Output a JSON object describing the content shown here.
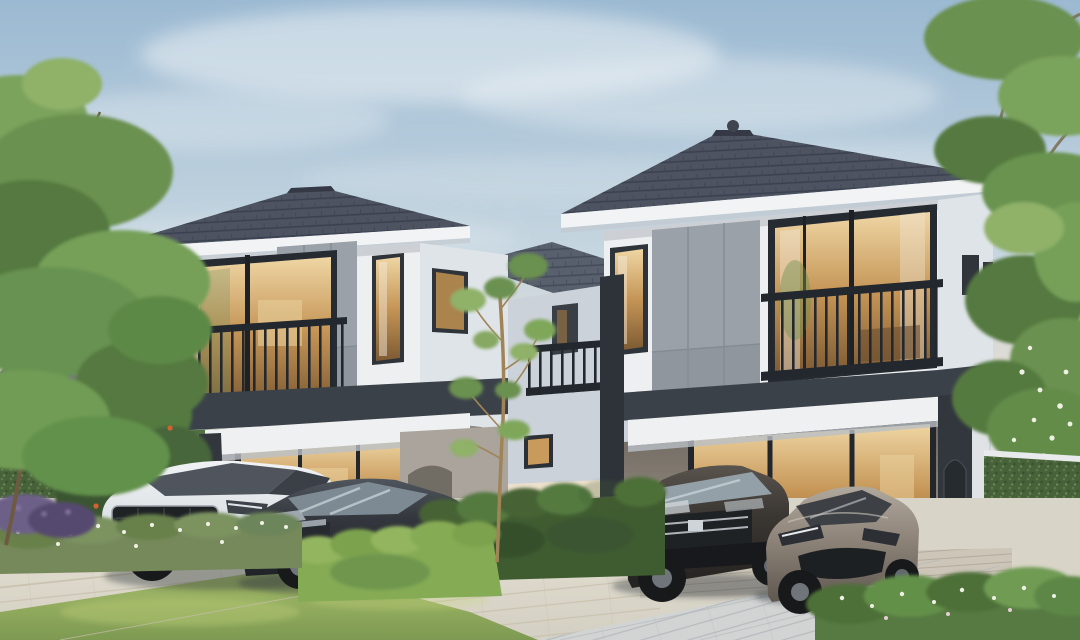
{
  "scene": {
    "description": "Dusk 3D exterior rendering of two modern two-storey houses with dark hip tile roofs, balconies with railings, and ground-floor carports; four cars parked; landscaped garden, hedges and paved driveway",
    "left_house": {
      "label": "left house",
      "cars": [
        "white SUV",
        "dark grey hatchback"
      ]
    },
    "right_house": {
      "label": "right house",
      "cars": [
        "dark grey SUV",
        "bronze-grey coupe"
      ]
    },
    "background": [
      "neighbouring house far left",
      "ivy-covered boundary walls",
      "large tree overhanging on the left",
      "tree branches overhanging top right",
      "young sapling between the houses"
    ],
    "foreground": [
      "pale paved driveway",
      "lawn",
      "trimmed hedges",
      "white flowering shrubs",
      "red flowering bush",
      "purple flowering bushes",
      "stepping stones",
      "deck strip"
    ]
  },
  "colors": {
    "sky_top": "#9bb9d2",
    "sky_mid": "#c6d6e0",
    "sky_low": "#e6ddd0",
    "sky_warm": "#f2e2c9",
    "cloud": "#f4f7f8",
    "roof": "#4d5360",
    "ridge": "#343945",
    "fascia": "#f1f3f4",
    "wall": "#edeff1",
    "wall_side": "#dfe4e9",
    "wall_shade": "#ccd2da",
    "bg_wall": "#e9e6df",
    "panel": "#9aa1a9",
    "band": "#3b4149",
    "beam": "#eef0f1",
    "frame": "#262b31",
    "rail": "#23282e",
    "glass_warm_hi": "#efd6a4",
    "glass_warm_mid": "#c49455",
    "glass_warm_lo": "#7d5a33",
    "ivy": "#47623a",
    "hedge_dark": "#3f5c31",
    "hedge_mid": "#557a41",
    "hedge_bright": "#86ab55",
    "grass_hi": "#a9bf6c",
    "grass_lo": "#7e9a52",
    "tree_green": "#6b9150",
    "tree_green_dark": "#55793f",
    "tree_green_light": "#8fb168",
    "trunk": "#6e5a40",
    "sapling_trunk": "#a08457",
    "paver_left_hi": "#e7e2d4",
    "paver_left_lo": "#d3cfc2",
    "paver_right": "#d2d4d3",
    "deck": "#ccc5b8",
    "ground_base": "#d8d4c7",
    "car_white": "#e9ebed",
    "car_dark": "#33373d",
    "car_suv": "#413d3a",
    "car_bronze": "#8e847c",
    "wheel": "#17191b",
    "flower_red": "#c4502e",
    "flower_white": "#eef0e4",
    "flower_purple": "#9181b1",
    "shadow": "#2f343a"
  }
}
